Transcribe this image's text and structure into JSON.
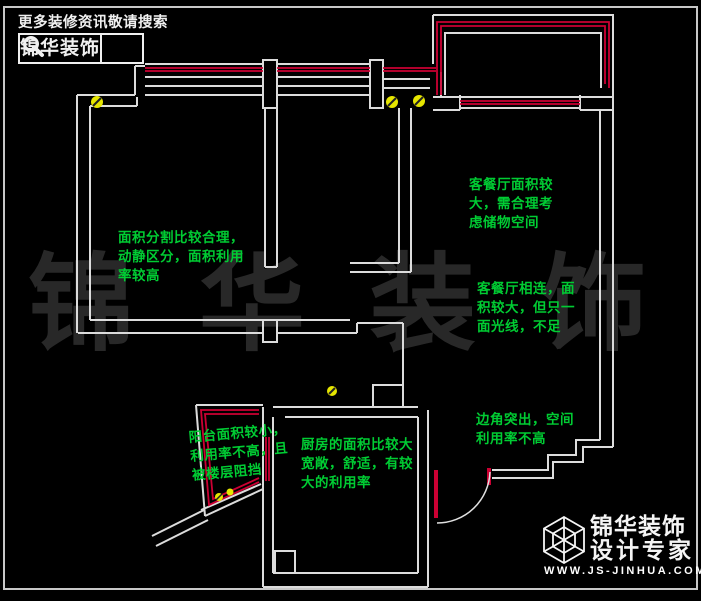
{
  "meta": {
    "background": "#000000",
    "wall_color": "#dcdcdc",
    "accent_red": "#cc0033",
    "annotation_green": "#00cc33",
    "symbol_yellow": "#e6e600",
    "watermark_color": "#282828"
  },
  "header": {
    "tagline": "更多装修资讯敬请搜索",
    "brand": "锦华装饰"
  },
  "watermark": {
    "text": "锦 华 装 饰"
  },
  "annotations": {
    "bedroom": "面积分割比较合理，\n动静区分，面积利用\n率较高",
    "storage": "客餐厅面积较\n大，需合理考\n虑储物空间",
    "living": "客餐厅相连，面\n积较大，但只一\n面光线，不足",
    "corner": "边角突出，空间\n利用率不高",
    "kitchen": "厨房的面积比较大\n宽敞，舒适，有较\n大的利用率",
    "balcony": "阳台面积较小，\n利用率不高，且\n被楼层阻挡"
  },
  "footer_logo": {
    "brand_line1": "锦华装饰",
    "brand_line2": "设计专家",
    "website": "WWW.JS-JINHUA.COM"
  }
}
